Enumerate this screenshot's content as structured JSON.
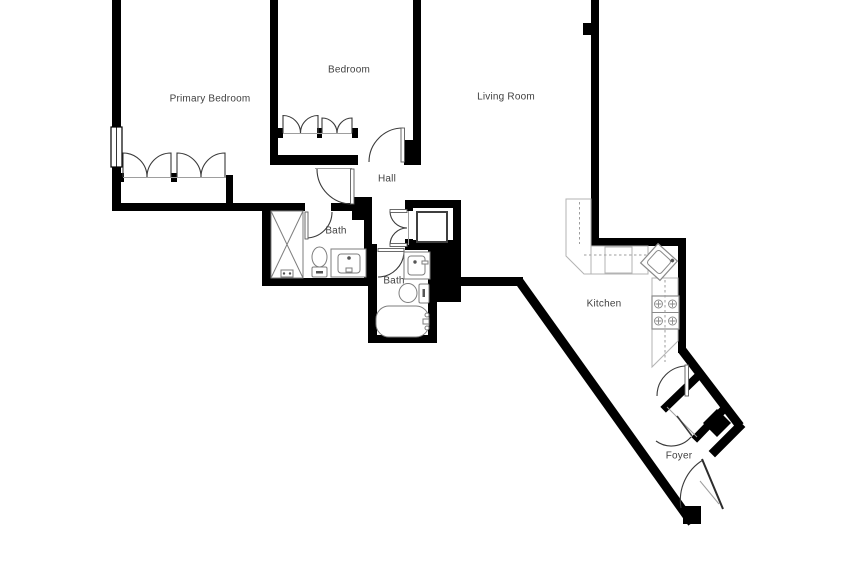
{
  "plan": {
    "name": "apartment-floor-plan",
    "rooms": [
      {
        "id": "primary-bedroom",
        "label": "Primary Bedroom",
        "x": 210,
        "y": 99
      },
      {
        "id": "bedroom",
        "label": "Bedroom",
        "x": 349,
        "y": 70
      },
      {
        "id": "living-room",
        "label": "Living Room",
        "x": 506,
        "y": 97
      },
      {
        "id": "hall",
        "label": "Hall",
        "x": 387,
        "y": 179
      },
      {
        "id": "bath-1",
        "label": "Bath",
        "x": 336,
        "y": 231
      },
      {
        "id": "bath-2",
        "label": "Bath",
        "x": 394,
        "y": 281
      },
      {
        "id": "kitchen",
        "label": "Kitchen",
        "x": 604,
        "y": 304
      },
      {
        "id": "foyer",
        "label": "Foyer",
        "x": 679,
        "y": 456
      }
    ],
    "fixtures": [
      "shower",
      "toilet",
      "vanity-sink",
      "toilet-2",
      "vanity-sink-2",
      "bathtub",
      "water-heater",
      "kitchen-sink",
      "range-stove",
      "counters",
      "bifold-closet-doors",
      "window",
      "entry-door"
    ],
    "colors": {
      "wall": "#000000",
      "fixture_line": "#7d7d7d",
      "counter_line": "#b3b3b3",
      "dashed_cabinet_line": "#9e9e9e",
      "label_text": "#3f3f3f",
      "background": "#ffffff"
    }
  }
}
